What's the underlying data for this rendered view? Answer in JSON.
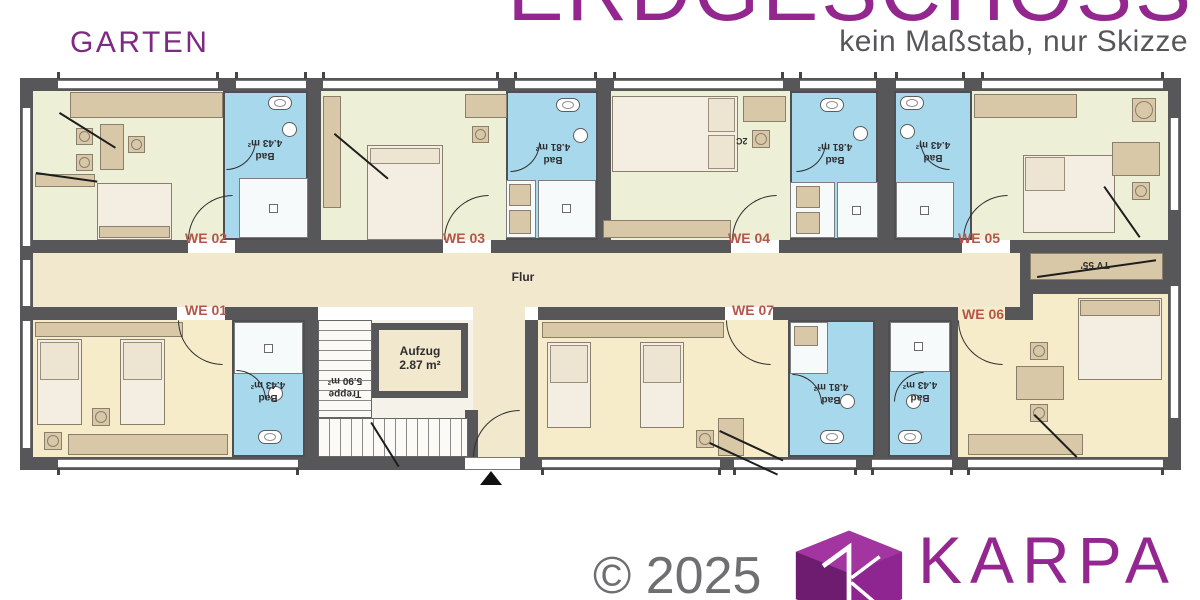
{
  "header": {
    "garden_label": "GARTEN",
    "title": "ERDGESCHOSS",
    "subtitle": "kein Maßstab, nur Skizze"
  },
  "plan": {
    "corridor_label": "Flur",
    "elevator_name": "Aufzug",
    "elevator_area": "2.87 m²",
    "stairs_name": "Treppe",
    "stairs_area": "5.90 m²",
    "tv_label": "TV 55'",
    "chair_note": "2C",
    "apartments": [
      {
        "label": "WE 01",
        "bath_name": "Bad",
        "bath_area": "4.43 m²"
      },
      {
        "label": "WE 02",
        "bath_name": "Bad",
        "bath_area": "4.43 m²"
      },
      {
        "label": "WE 03",
        "bath_name": "Bad",
        "bath_area": "4.81 m²"
      },
      {
        "label": "WE 04",
        "bath_name": "Bad",
        "bath_area": "4.81 m²"
      },
      {
        "label": "WE 05",
        "bath_name": "Bad",
        "bath_area": "4.43 m²"
      },
      {
        "label": "WE 06",
        "bath_name": "Bad",
        "bath_area": "4.43 m²"
      },
      {
        "label": "WE 07",
        "bath_name": "Bad",
        "bath_area": "4.81 m²"
      }
    ]
  },
  "footer": {
    "copyright": "© 2025",
    "brand": "KARPA"
  },
  "colors": {
    "accent_purple": "#93278f",
    "label_red": "#b2584a",
    "bath_blue": "#a8d8ec",
    "wall_gray": "#57575a",
    "room_green": "#edefd6",
    "room_cream": "#f6ecca",
    "corridor_cream": "#f2e8cd"
  }
}
